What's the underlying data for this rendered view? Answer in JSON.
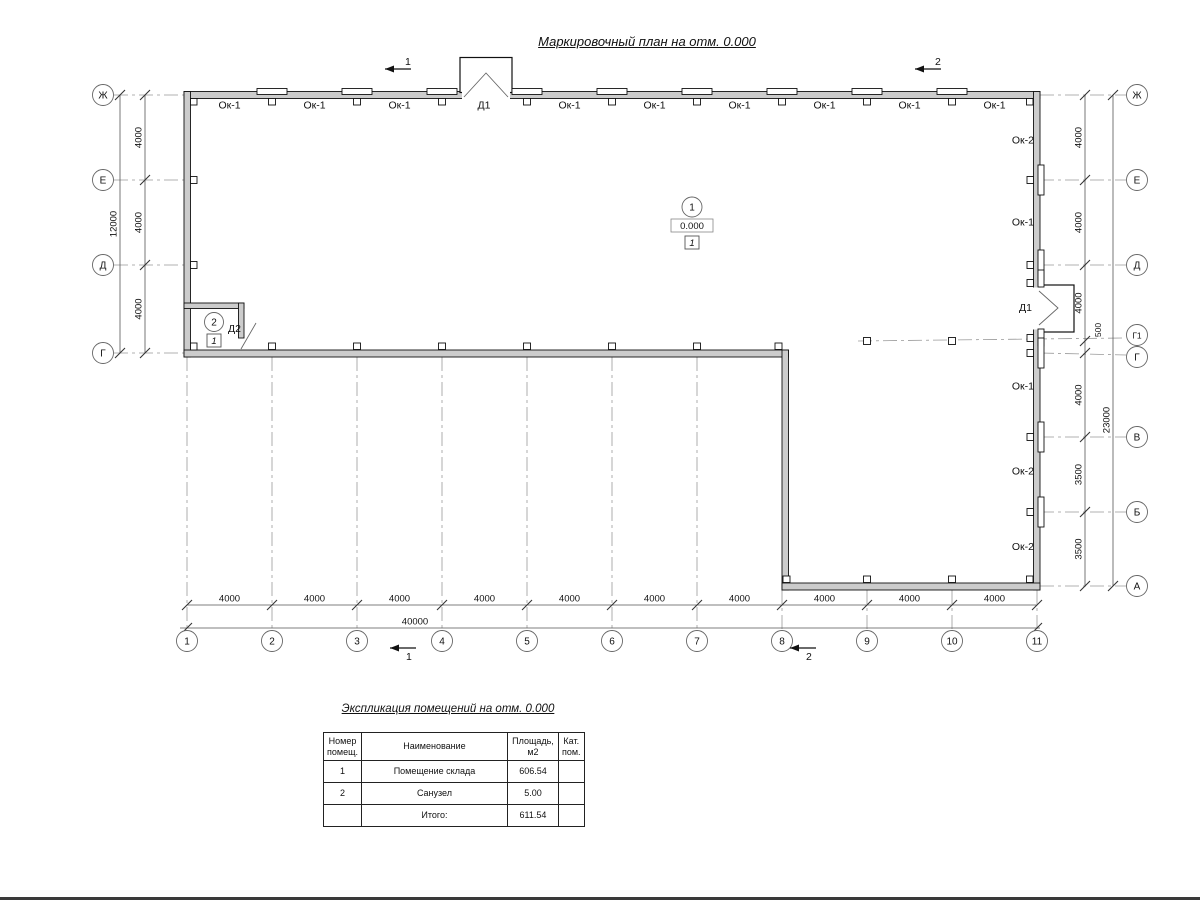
{
  "title": "Маркировочный план на отм. 0.000",
  "axes": {
    "left": [
      "Ж",
      "Е",
      "Д",
      "Г"
    ],
    "right": [
      "Ж",
      "Е",
      "Д",
      "Г1",
      "Г",
      "В",
      "Б",
      "А"
    ],
    "bottom": [
      "1",
      "2",
      "3",
      "4",
      "5",
      "6",
      "7",
      "8",
      "9",
      "10",
      "11"
    ]
  },
  "dims": {
    "left_segments": [
      "4000",
      "4000",
      "4000"
    ],
    "left_total": "12000",
    "right_upper": [
      "4000",
      "4000",
      "4000"
    ],
    "right_offset": "500",
    "right_lower": [
      "4000",
      "3500",
      "3500"
    ],
    "right_total": "23000",
    "bottom_segments": [
      "4000",
      "4000",
      "4000",
      "4000",
      "4000",
      "4000",
      "4000",
      "4000",
      "4000",
      "4000"
    ],
    "bottom_total": "40000"
  },
  "section_marks": {
    "top1": "1",
    "top2": "2",
    "bottom1": "1",
    "bottom2": "2"
  },
  "labels": {
    "top_windows": [
      "Ок-1",
      "Ок-1",
      "Ок-1",
      "Ок-1",
      "Ок-1",
      "Ок-1",
      "Ок-1",
      "Ок-1",
      "Ок-1"
    ],
    "top_door": "Д1",
    "right_openings": [
      "Ок-2",
      "Ок-1",
      "Д1",
      "Ок-1",
      "Ок-2",
      "Ок-2"
    ],
    "interior_door": "Д2"
  },
  "rooms": {
    "r1": {
      "number": "1",
      "elevation": "0.000",
      "floor_type": "1"
    },
    "r2": {
      "number": "2",
      "floor_type": "1"
    }
  },
  "table": {
    "title": "Экспликация помещений на отм. 0.000",
    "headers": [
      "Номер помещ.",
      "Наименование",
      "Площадь, м2",
      "Кат. пом."
    ],
    "rows": [
      {
        "num": "1",
        "name": "Помещение склада",
        "area": "606.54",
        "cat": ""
      },
      {
        "num": "2",
        "name": "Санузел",
        "area": "5.00",
        "cat": ""
      }
    ],
    "total_label": "Итого:",
    "total_value": "611.54"
  },
  "colors": {
    "wall_fill": "#cccccc",
    "wall_line": "#111111",
    "dim_line": "#555555",
    "axis_line": "#999999"
  }
}
